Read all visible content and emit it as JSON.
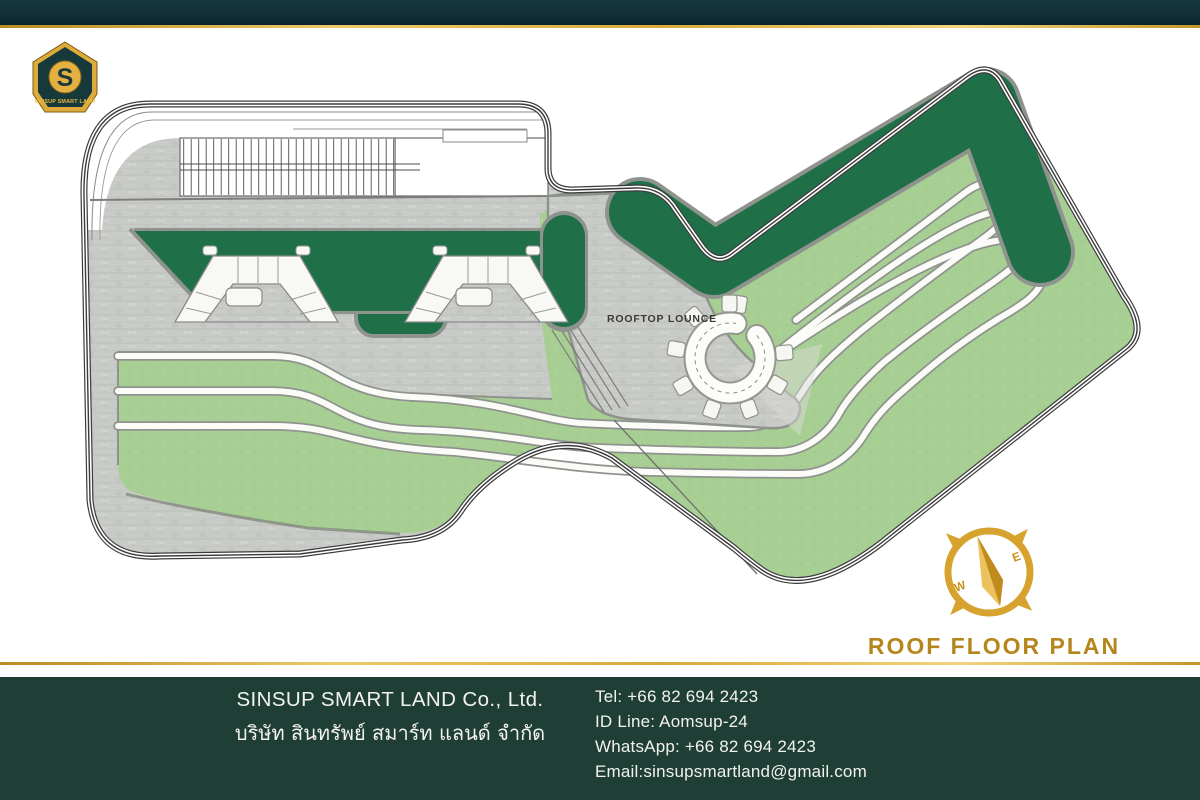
{
  "brand": {
    "monogram": "S",
    "name": "SINSUP SMART LAND"
  },
  "plan": {
    "lounge_label": "ROOFTOP LOUNCE",
    "title": "ROOF FLOOR PLAN",
    "compass": {
      "west": "W",
      "east": "E"
    }
  },
  "colors": {
    "gold": "#d8a634",
    "gold_dark": "#b5861c",
    "dark_green": "#1f6f49",
    "light_green": "#a8cf93",
    "paving_gray": "#c9cbc8",
    "header_teal": "#12303a",
    "footer_green": "#1f3e36"
  },
  "footer": {
    "company_en": "SINSUP SMART LAND Co., Ltd.",
    "company_th": "บริษัท สินทรัพย์ สมาร์ท แลนด์ จำกัด",
    "lines": [
      "Tel: +66 82 694 2423",
      "ID Line: Aomsup-24",
      "WhatsApp: +66 82 694 2423",
      "Email:sinsupsmartland@gmail.com"
    ]
  }
}
